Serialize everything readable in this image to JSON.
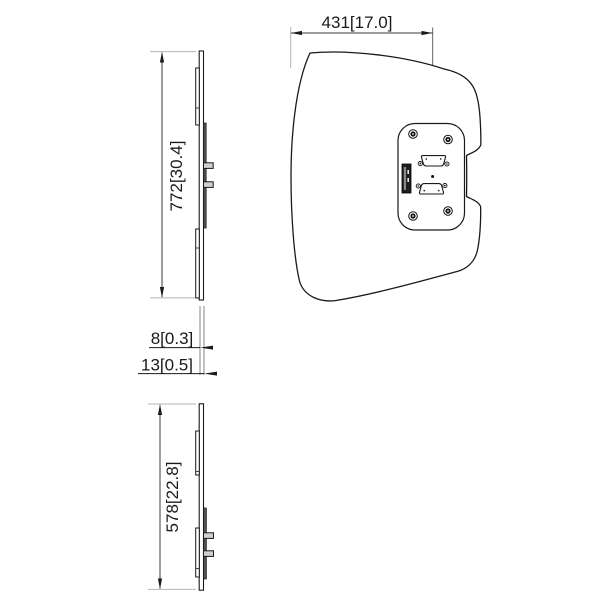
{
  "drawing": {
    "type": "engineering-dimension-drawing",
    "subject": "display-back-panel-with-vesa-mount",
    "colors": {
      "background": "#ffffff",
      "outline": "#1a1a1a",
      "dimension_line": "#3a3a3a",
      "extension_line": "#b4b4b4",
      "rail_fill": "#4f4f4f",
      "peg_fill": "#cfcfcf",
      "port_fill": "#1f1f1f"
    },
    "views": {
      "side_upper": {
        "name": "side-view-tall",
        "dim_height": "772[30.4]"
      },
      "front": {
        "name": "front-view",
        "dim_width": "431[17.0]"
      },
      "thickness": {
        "dim_plate": "8[0.3]",
        "dim_total": "13[0.5]"
      },
      "side_lower": {
        "name": "side-view-short",
        "dim_height": "578[22.8]"
      }
    },
    "icons": [
      "screw-icon",
      "dsub-connector-icon",
      "usb-port-icon",
      "arrowhead-icon",
      "center-line",
      "center-dot"
    ]
  }
}
